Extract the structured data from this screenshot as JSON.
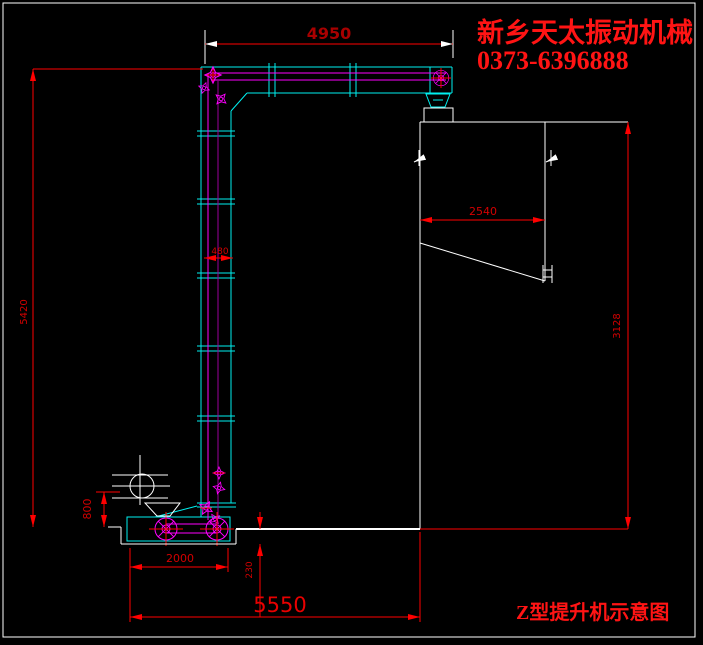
{
  "company": {
    "name": "新乡天太振动机械",
    "phone": "0373-6396888"
  },
  "title": "Z型提升机示意图",
  "dims": {
    "top_width": "4950",
    "overall_height": "5420",
    "hopper_width": "2540",
    "hopper_height": "3128",
    "casing_width": "480",
    "feed_height": "800",
    "boot_length": "2000",
    "pit_depth": "230",
    "overall_length": "5550"
  },
  "colors": {
    "background": "#000000",
    "casing_outline": "#00f0f0",
    "chain_magenta": "#ff00ff",
    "chain_purple": "#9b009b",
    "dimension_line": "#ff0000",
    "dimension_text": "#d40000",
    "brand_red": "#ff1414",
    "drawing_white": "#ffffff"
  }
}
